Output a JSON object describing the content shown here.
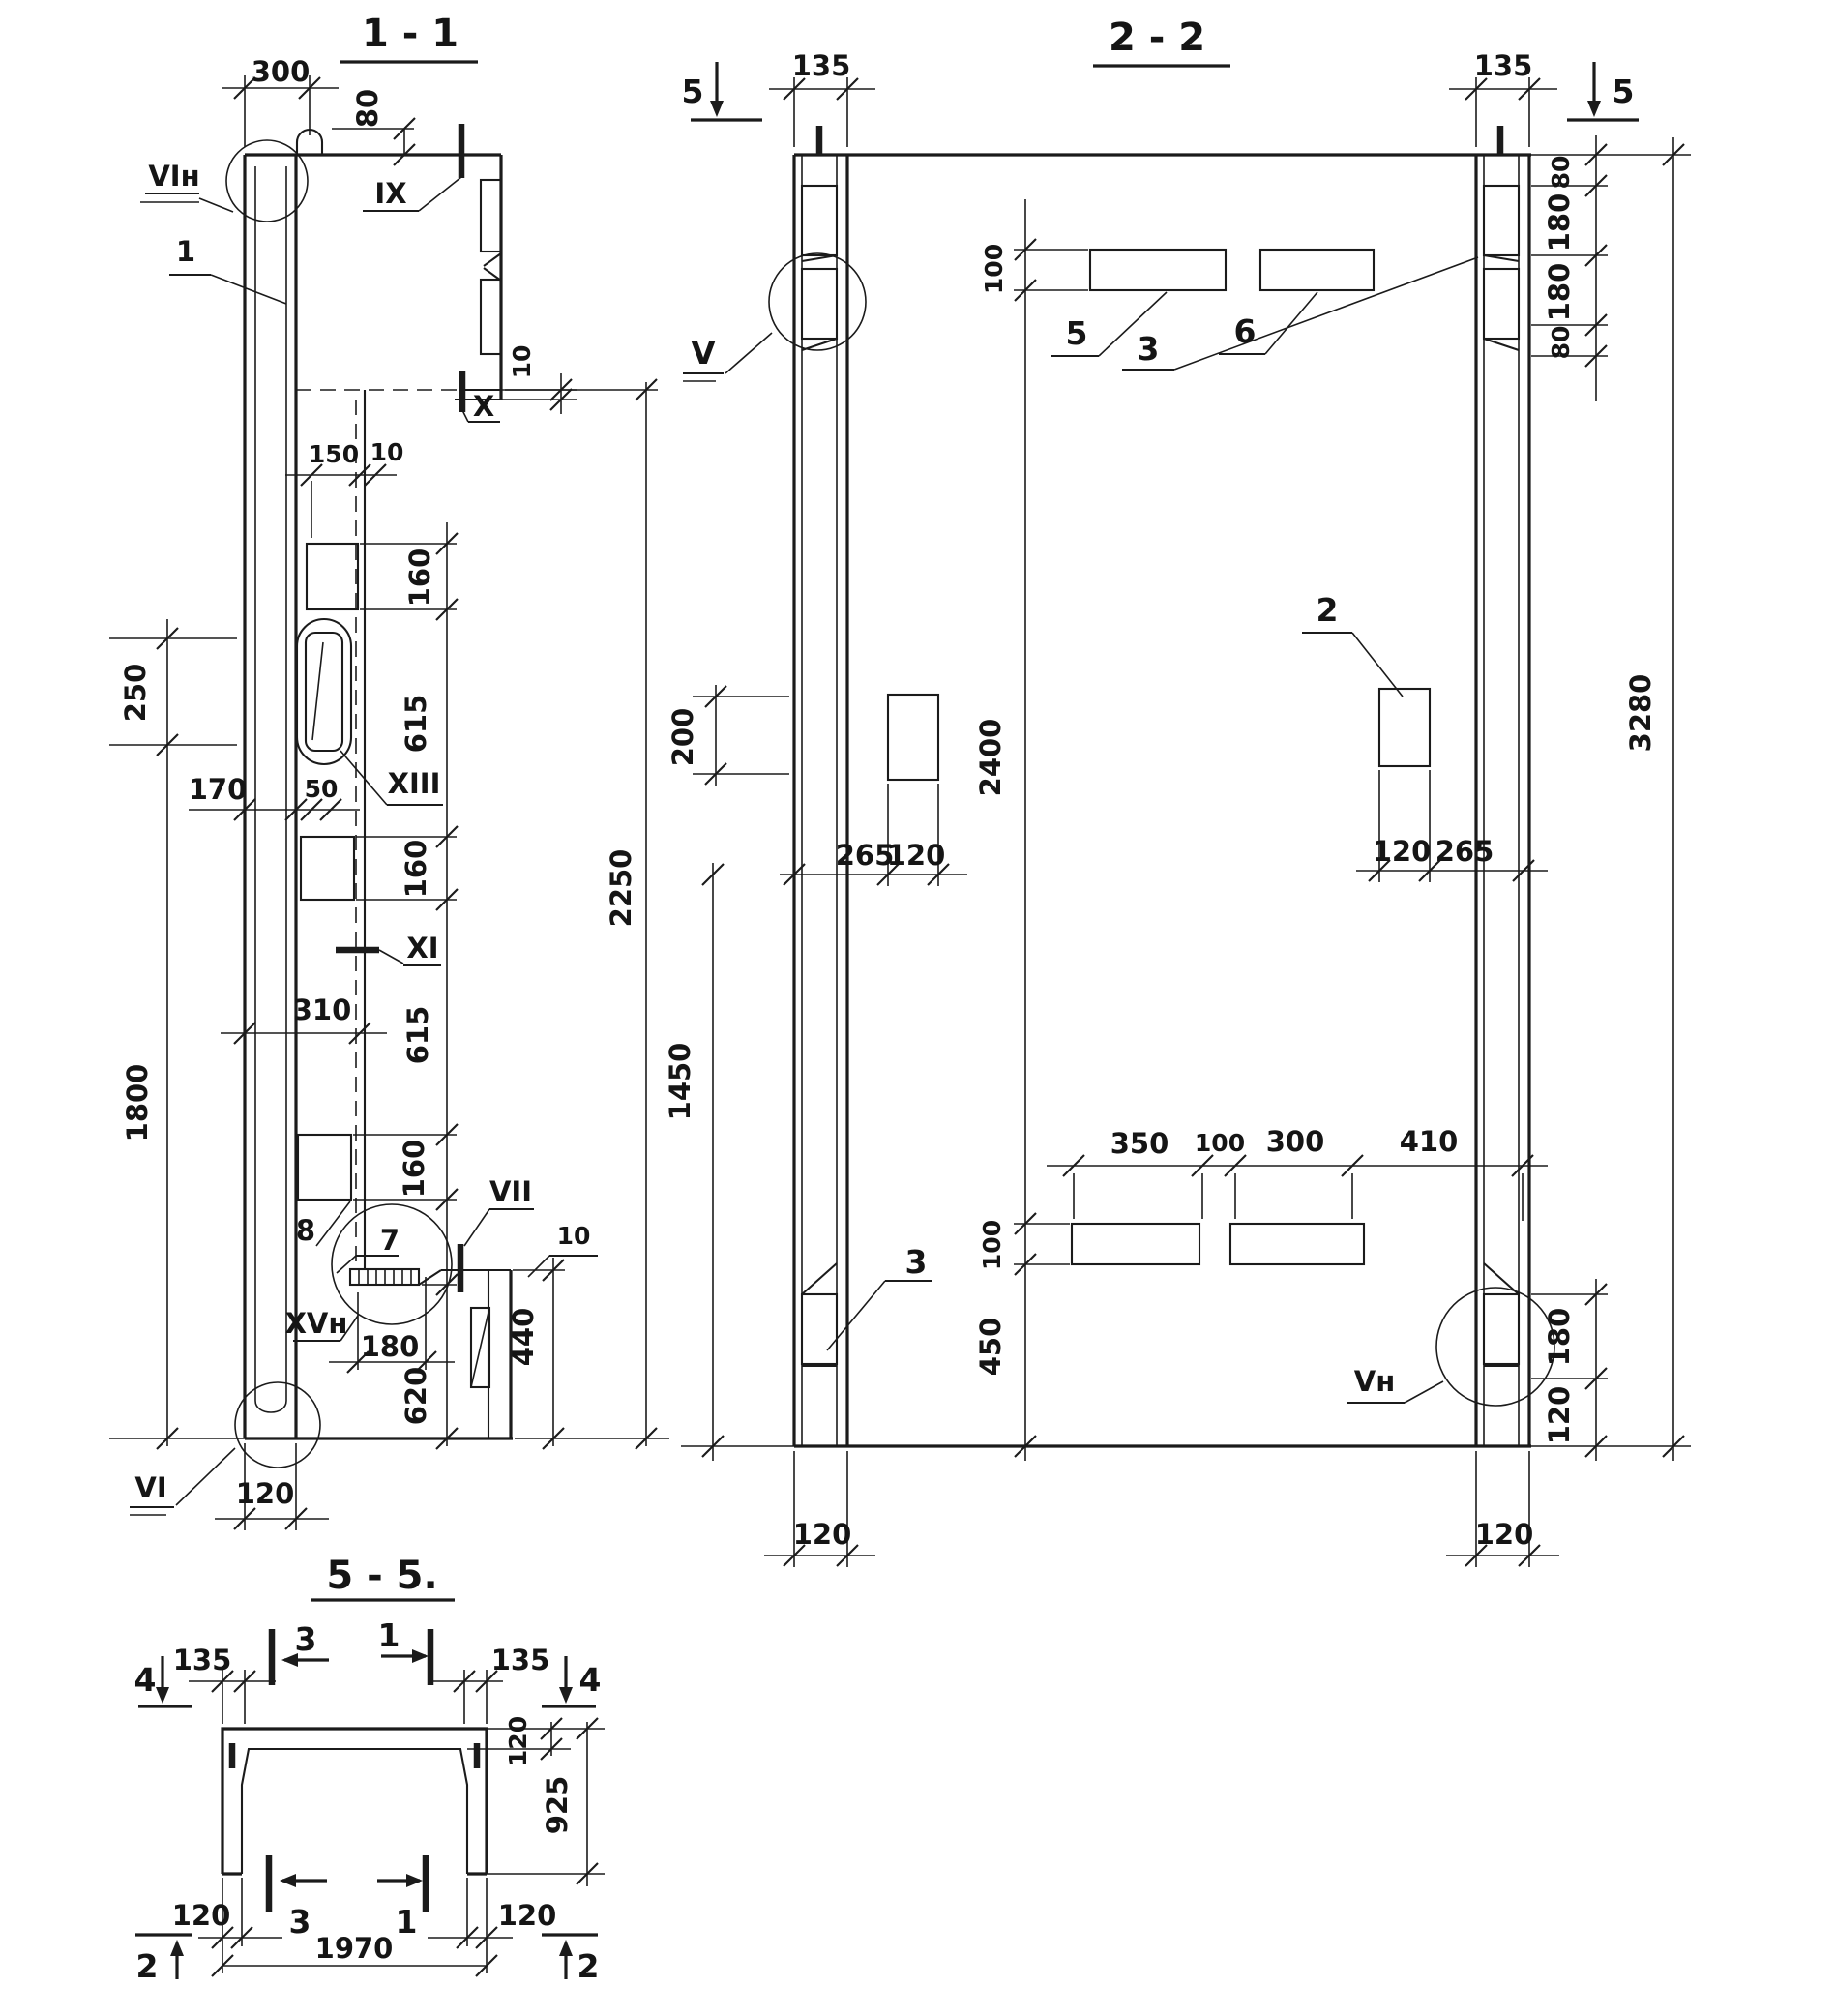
{
  "sections": {
    "s1": {
      "title": "1 - 1"
    },
    "s2": {
      "title": "2 - 2"
    },
    "s5": {
      "title": "5 - 5."
    }
  },
  "dims": {
    "d300": "300",
    "d80": "80",
    "d10": "10",
    "d150": "150",
    "d160": "160",
    "d615": "615",
    "d250": "250",
    "d170": "170",
    "d50": "50",
    "d310": "310",
    "d1800": "1800",
    "d2250": "2250",
    "d180": "180",
    "d620": "620",
    "d440": "440",
    "d120": "120",
    "d135": "135",
    "d100": "100",
    "d200": "200",
    "d265": "265",
    "d2400": "2400",
    "d1450": "1450",
    "d450": "450",
    "d350": "350",
    "d410": "410",
    "d3280": "3280",
    "d925": "925",
    "d1970": "1970"
  },
  "marks": {
    "ix": "IX",
    "x": "X",
    "xi": "XI",
    "xiii": "XIII",
    "vii": "VII",
    "xvn": "XVн",
    "vin": "VIн",
    "vi": "VI",
    "v": "V",
    "vn": "Vн"
  },
  "callouts": {
    "c1": "1",
    "c2": "2",
    "c3": "3",
    "c4": "4",
    "c5": "5",
    "c6": "6",
    "c7": "7",
    "c8": "8"
  }
}
